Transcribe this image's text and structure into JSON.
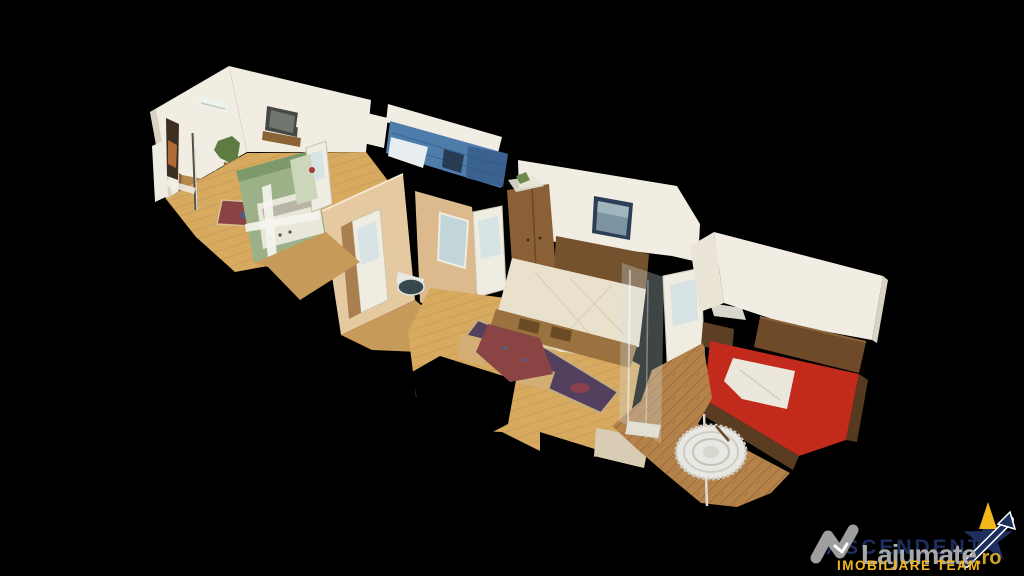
{
  "scene": {
    "kind": "3d-dollhouse-apartment-scan",
    "rooms": [
      "living-room",
      "kitchen",
      "top-room",
      "bathroom",
      "hallway",
      "dining-area",
      "bedroom-1",
      "bedroom-2"
    ]
  },
  "watermark": {
    "agency_name": "ASCENDENT",
    "agency_tagline": "IMOBILIARE TEAM",
    "site_name": "Lajumate",
    "site_tld": ".ro"
  },
  "palette": {
    "wall_white": "#f1ede3",
    "wall_shadow": "#d9d3c4",
    "wall_cream": "#e5c9a1",
    "wall_cream_dark": "#dcba8e",
    "wall_green": "#9db189",
    "wall_green_dark": "#7d986b",
    "tile_blue": "#4e7dab",
    "tile_blue_dark": "#3a6190",
    "floor_tan": "#d7aa60",
    "floor_mid": "#c69a58",
    "floor_wood": "#b5824a",
    "floor_wood_dark": "#8f6437",
    "wood": "#7c5a35",
    "wood_dark": "#553a20",
    "bed_cream": "#eae1cd",
    "bed_red": "#c22a1b",
    "rug_red": "#8a4242",
    "rug_purple": "#53405e",
    "frame_navy": "#2c3d57",
    "glass": "#cfe0e4",
    "watermark_navy": "#1d2e5e",
    "watermark_gray": "#a8a8a8",
    "watermark_yellow": "#f2b719",
    "watermark_orange": "#cfa42a",
    "background": "#000000"
  }
}
